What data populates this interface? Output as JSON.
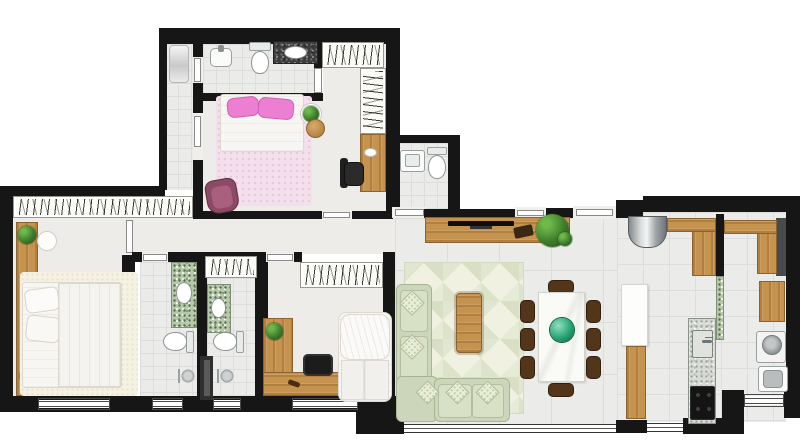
{
  "meta": {
    "kind": "residential-floor-plan-top-view",
    "visible_text": "none"
  },
  "palette": {
    "wall": "#161616",
    "floor": "#ebecea",
    "floor-line": "#dddedc",
    "wood": "#c6934f",
    "wood-dark": "#8a6330",
    "sofa": "#ccd6ba",
    "sofa-light": "#d8e0c6",
    "chair": "#53361a",
    "rug-living": "#f0f1e0",
    "rug-pink": "#f3e0ec",
    "rug-cream": "#f5f2e3",
    "pink-pillow": "#ec7fd2",
    "purple-armchair": "#8d4a66",
    "plant-green": "#3e7d2c",
    "greenspk": "#b7c8ac",
    "granite": "#d7dad5",
    "steel": "#c9cdcf",
    "teal-bowl": "#1f8f63"
  },
  "rooms": [
    {
      "name": "suite-bedroom-top",
      "fixtures": [
        "double-bed-pink-pillows",
        "pink-rug",
        "purple-armchair",
        "plant-side-table",
        "wood-stool",
        "wardrobe-hatch",
        "desk-wood-strip",
        "office-chair"
      ]
    },
    {
      "name": "suite-bathroom-top",
      "fixtures": [
        "pedestal-sink",
        "toilet",
        "dark-counter-oval-sink",
        "shower-corner"
      ]
    },
    {
      "name": "powder-room",
      "fixtures": [
        "square-sink",
        "toilet"
      ]
    },
    {
      "name": "master-bedroom-left",
      "fixtures": [
        "double-bed",
        "cream-rug",
        "wood-shelf",
        "plants",
        "side-disc-table",
        "wardrobe-hatch",
        "window"
      ]
    },
    {
      "name": "bathroom-a",
      "fixtures": [
        "green-counter-sink",
        "toilet",
        "shower-fixture",
        "window"
      ]
    },
    {
      "name": "bathroom-b",
      "fixtures": [
        "green-counter-sink",
        "toilet",
        "shower-fixture",
        "window",
        "hall-closet-hatch"
      ]
    },
    {
      "name": "bedroom-2",
      "fixtures": [
        "single-bed",
        "l-shaped-desk",
        "black-machine",
        "plant",
        "wardrobe-hatch",
        "window"
      ]
    },
    {
      "name": "living-room",
      "fixtures": [
        "l-shaped-sofa",
        "patterned-rug",
        "coffee-table",
        "tv-console",
        "tv",
        "plant",
        "dining-table-8-chairs",
        "green-glass-bowl",
        "glass-window-band",
        "entrance-door"
      ]
    },
    {
      "name": "kitchen",
      "fixtures": [
        "steel-cylinder-cabinet",
        "wood-counter-l1",
        "wood-counter-l2",
        "white-island",
        "wood-island-base",
        "granite-counter",
        "sink",
        "black-cooktop"
      ]
    },
    {
      "name": "laundry",
      "fixtures": [
        "washing-machine",
        "laundry-tank",
        "window"
      ]
    }
  ]
}
